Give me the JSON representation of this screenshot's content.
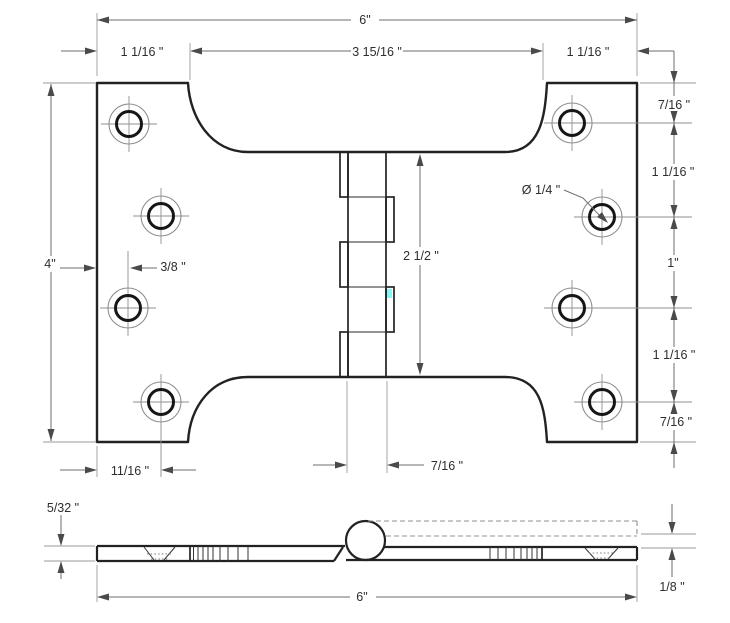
{
  "drawing": {
    "type": "technical-drawing",
    "subject": "parliament door hinge, plan view and edge view with dimensions",
    "units": "inches",
    "colors": {
      "background": "#ffffff",
      "outline": "#222222",
      "dimension_lines": "#6e6e6e",
      "text": "#2e2e2e",
      "artifact_cyan": "#7df4f4"
    }
  },
  "plan_view": {
    "labels": {
      "top_width": "6\"",
      "left_offset": "1 1/16 \"",
      "center_span": "3 15/16 \"",
      "right_offset": "1 1/16 \"",
      "height": "4\"",
      "hole_backset": "3/8 \"",
      "knuckle_length": "2 1/2 \"",
      "hole_diameter": "Ø 1/4 \"",
      "bottom_hole_offset": "11/16 \"",
      "barrel_width": "7/16 \"",
      "right_chain": [
        "7/16 \"",
        "1 1/16 \"",
        "1\"",
        "1 1/16 \"",
        "7/16 \""
      ]
    }
  },
  "side_view": {
    "labels": {
      "leaf_thickness": "5/32 \"",
      "overall_width": "6\"",
      "hinge_gap": "1/8 \""
    }
  }
}
